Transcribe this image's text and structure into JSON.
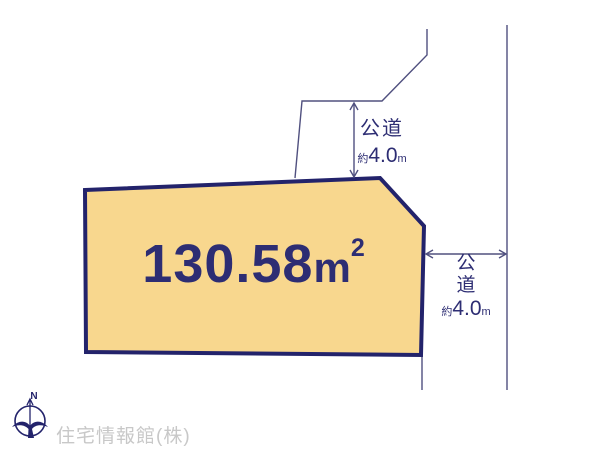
{
  "colors": {
    "navy": "#23236b",
    "text_navy": "#2d2d73",
    "thin_line": "#50507f",
    "parcel_fill": "#f8d78e",
    "watermark_gray": "#c8c8c8"
  },
  "parcel": {
    "area_value": "130.58",
    "area_unit": "m",
    "area_exponent": "2"
  },
  "road_top": {
    "label": "公道",
    "approx": "約",
    "width": "4.0",
    "unit": "m"
  },
  "road_right": {
    "label_char_1": "公",
    "label_char_2": "道",
    "approx": "約",
    "width": "4.0",
    "unit": "m"
  },
  "compass": {
    "north_label": "N"
  },
  "watermark": {
    "company": "住宅情報館(株)"
  }
}
